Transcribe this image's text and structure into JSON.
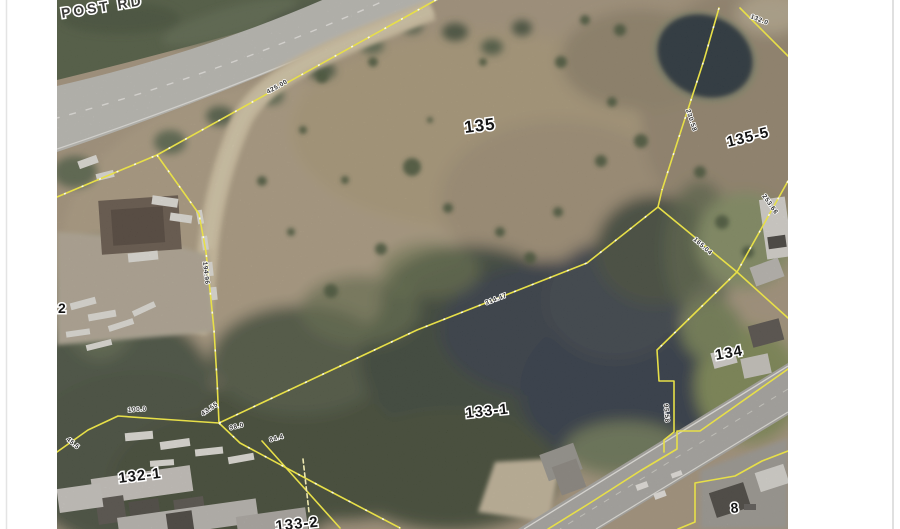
{
  "map": {
    "street_label": {
      "text": "POST RD"
    },
    "parcels": [
      {
        "id": "135"
      },
      {
        "id": "135-5"
      },
      {
        "id": "134"
      },
      {
        "id": "133-1"
      },
      {
        "id": "132-1"
      },
      {
        "id": "133-2"
      },
      {
        "id": "2"
      },
      {
        "id": "8"
      }
    ],
    "dimension_labels": [
      {
        "text": "425.00"
      },
      {
        "text": "230.58"
      },
      {
        "text": "194.96"
      },
      {
        "text": "132.0"
      },
      {
        "text": "100.0"
      },
      {
        "text": "43.55"
      },
      {
        "text": "98.0"
      },
      {
        "text": "84.4"
      },
      {
        "text": "45.5"
      },
      {
        "text": "314.47"
      },
      {
        "text": "165.04"
      },
      {
        "text": "95.58"
      },
      {
        "text": "253.66"
      }
    ],
    "colors": {
      "boundary_yellow": "#e7df48",
      "water_dark": "#1f2936",
      "field_tan": "#a3937b",
      "woods_green": "#414c3a",
      "road_gray": "#bcbcb8",
      "margin_white": "#ffffff"
    }
  }
}
